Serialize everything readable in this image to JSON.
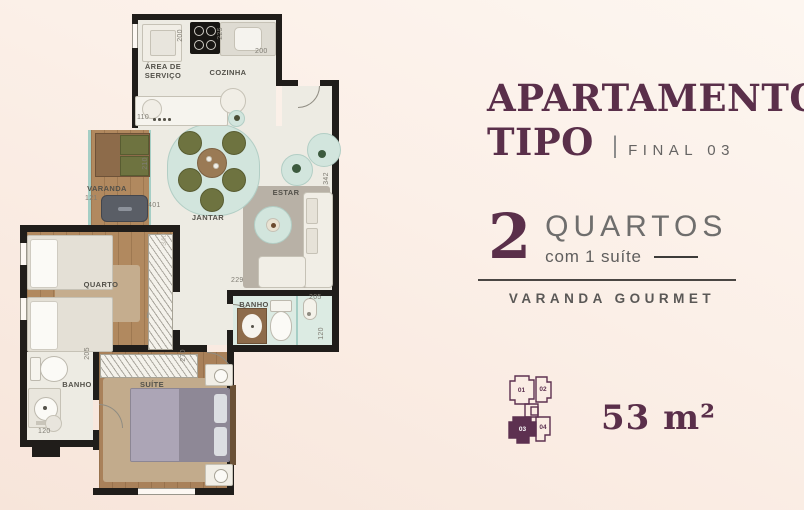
{
  "colors": {
    "accent": "#5a2f4a",
    "text_gray": "#6b6b6b",
    "wall": "#201d1a",
    "teal": "#d2e5dd"
  },
  "panel": {
    "title_line1": "APARTAMENTO",
    "title_line2": "TIPO",
    "separator": "|",
    "final_label": "FINAL 03",
    "rooms_count": "2",
    "rooms_label": "QUARTOS",
    "suite_note": "com 1 suíte",
    "feature_label": "VARANDA GOURMET",
    "area_label": "53 m²"
  },
  "keyplan": {
    "units": [
      "01",
      "02",
      "03",
      "04"
    ],
    "highlighted_unit": "03"
  },
  "plan": {
    "rooms": {
      "area_servico": "ÁREA DE SERVIÇO",
      "cozinha": "COZINHA",
      "varanda": "VARANDA",
      "jantar": "JANTAR",
      "estar": "ESTAR",
      "quarto": "QUARTO",
      "banho_social": "BANHO",
      "banho_suite": "BANHO",
      "suite": "SUÍTE"
    },
    "dims": {
      "servico_largura": "200",
      "cozinha_parede": "225",
      "cozinha_largura": "200",
      "bancada": "110",
      "varanda_largura": "121",
      "varanda_profundidade": "210",
      "jantar_largura": "401",
      "estar_profundidade": "342",
      "quarto_profundidade": "340",
      "estar_largura": "229",
      "banho_social_largura": "205",
      "banho_social_profundidade": "120",
      "suite_parede": "205",
      "armario_largura": "270",
      "banho_suite_largura": "120"
    }
  }
}
